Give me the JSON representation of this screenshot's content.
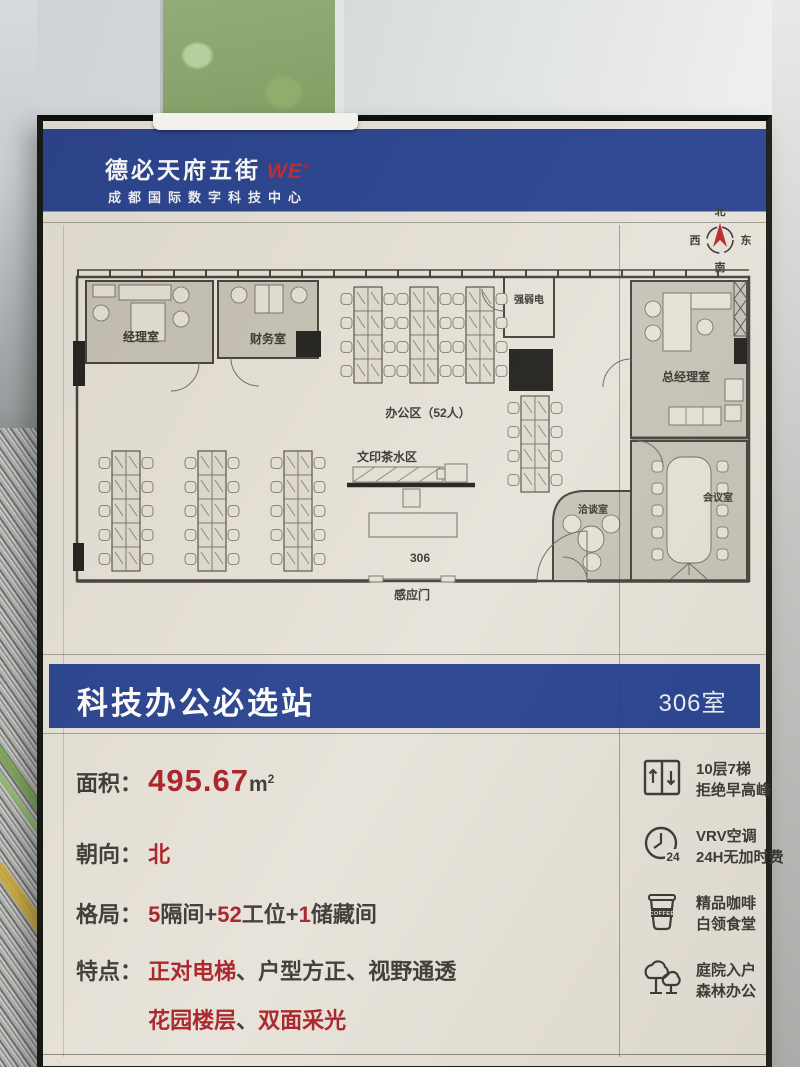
{
  "header": {
    "brand": "德必天府五街",
    "logo": "WE",
    "logo_sup": "+",
    "subtitle": "成都国际数字科技中心"
  },
  "compass": {
    "n": "北",
    "s": "南",
    "e": "东",
    "w": "西"
  },
  "floorplan": {
    "manager_office": "经理室",
    "finance_office": "财务室",
    "office_area": "办公区（52人）",
    "electrical_room": "强弱电",
    "gm_office": "总经理室",
    "print_tea_area": "文印茶水区",
    "negotiation_room": "洽谈室",
    "meeting_room": "会议室",
    "unit_number": "306",
    "sensor_door": "感应门"
  },
  "banner": {
    "title": "科技办公必选站",
    "room_no": "306室"
  },
  "info": {
    "area_label": "面积：",
    "area_value": "495.67",
    "area_unit": "m",
    "area_sup": "2",
    "facing_label": "朝向：",
    "facing_value": "北",
    "layout_label": "格局：",
    "layout_parts": {
      "n1": "5",
      "t1": "隔间+",
      "n2": "52",
      "t2": "工位+",
      "n3": "1",
      "t3": "储藏间"
    },
    "feature_label": "特点：",
    "feature_line1": {
      "r1": "正对电梯",
      "d1": "、",
      "d2": "户型方正",
      "d3": "、",
      "d4": "视野通透"
    },
    "feature_line2": {
      "r1": "花园楼层",
      "d1": "、",
      "r2": "双面采光"
    }
  },
  "amenities": [
    {
      "icon": "elevator-icon",
      "line1": "10层7梯",
      "line2": "拒绝早高峰"
    },
    {
      "icon": "clock-icon",
      "line1": "VRV空调",
      "line2": "24H无加时费",
      "badge": "24"
    },
    {
      "icon": "coffee-icon",
      "line1": "精品咖啡",
      "line2": "白领食堂",
      "badge": "COFFEE"
    },
    {
      "icon": "trees-icon",
      "line1": "庭院入户",
      "line2": "森林办公"
    }
  ],
  "colors": {
    "banner_blue": "#27418f",
    "accent_red": "#a81e24",
    "logo_red": "#c1272d",
    "text_dark": "#3b3833"
  }
}
